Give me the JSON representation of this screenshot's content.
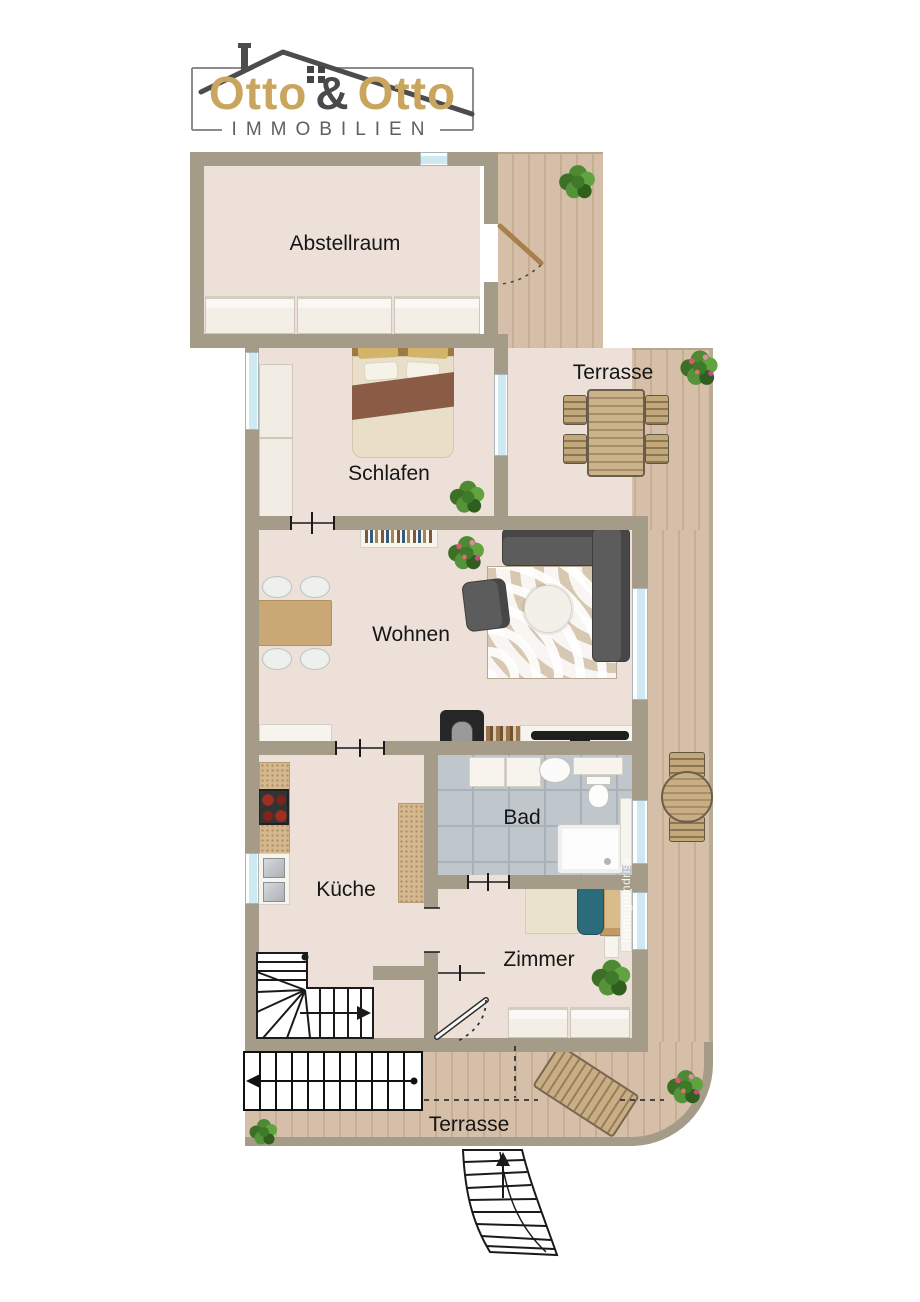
{
  "logo": {
    "word1": "Otto",
    "amp": "&",
    "word2": "Otto",
    "subtitle": "IMMOBILIEN",
    "gold": "#c9a55e",
    "gray": "#4a4a4a"
  },
  "rooms": {
    "abstellraum": {
      "label": "Abstellraum"
    },
    "terrasse_top": {
      "label": "Terrasse"
    },
    "schlafen": {
      "label": "Schlafen"
    },
    "wohnen": {
      "label": "Wohnen"
    },
    "bad": {
      "label": "Bad"
    },
    "kueche": {
      "label": "Küche"
    },
    "zimmer": {
      "label": "Zimmer"
    },
    "terrasse_bottom": {
      "label": "Terrasse"
    }
  },
  "watermark": {
    "text": "Immogrundriss"
  },
  "colors": {
    "wall": "#a49c89",
    "floor": "#ece0d8",
    "deck": "#d2bba3",
    "bath_tile": "#bfc6cc",
    "window_glass": "#cfe9f2",
    "sofa": "#5c5c5c",
    "wood_furniture": "#c9a876",
    "bed_blanket_brown": "#8a5c45",
    "bed_blanket_teal": "#2c6b7b"
  }
}
